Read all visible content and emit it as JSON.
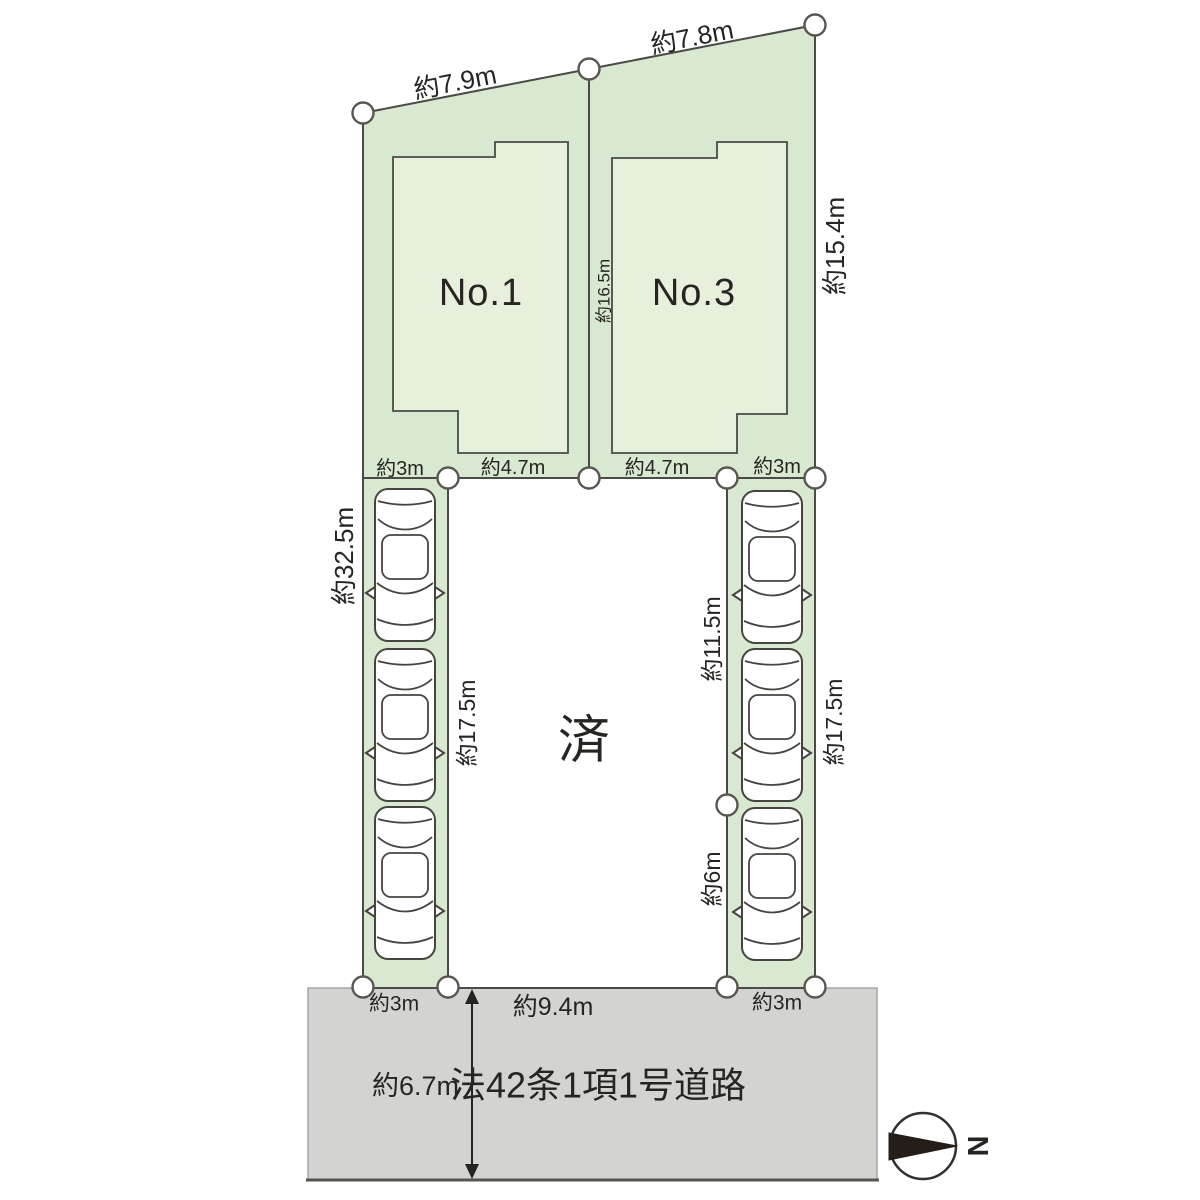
{
  "colors": {
    "plot_fill": "#d9e8d0",
    "building_fill": "#e6f0dd",
    "road_fill": "#d3d3d2",
    "outline": "#4a4a47",
    "text": "#262522",
    "compass_needle": "#241d18"
  },
  "diagram": {
    "plots": [
      {
        "label": "No.1"
      },
      {
        "label": "No.3"
      }
    ],
    "sold_label": "済",
    "dims": {
      "top_left_edge": "約7.9m",
      "top_right_edge": "約7.8m",
      "left_edge": "約32.5m",
      "center_divider": "約16.5m",
      "right_edge_upper": "約15.4m",
      "plot1_front_left": "約3m",
      "plot1_front_right": "約4.7m",
      "plot3_front_left": "約4.7m",
      "plot3_front_right": "約3m",
      "left_strip_inner": "約17.5m",
      "right_strip_inner_upper": "約11.5m",
      "right_strip_inner_lower": "約6m",
      "right_strip_outer": "約17.5m",
      "left_strip_bottom": "約3m",
      "center_bottom": "約9.4m",
      "right_strip_bottom": "約3m",
      "road_width": "約6.7m"
    },
    "road_label": "法42条1項1号道路",
    "compass_north": "N"
  }
}
